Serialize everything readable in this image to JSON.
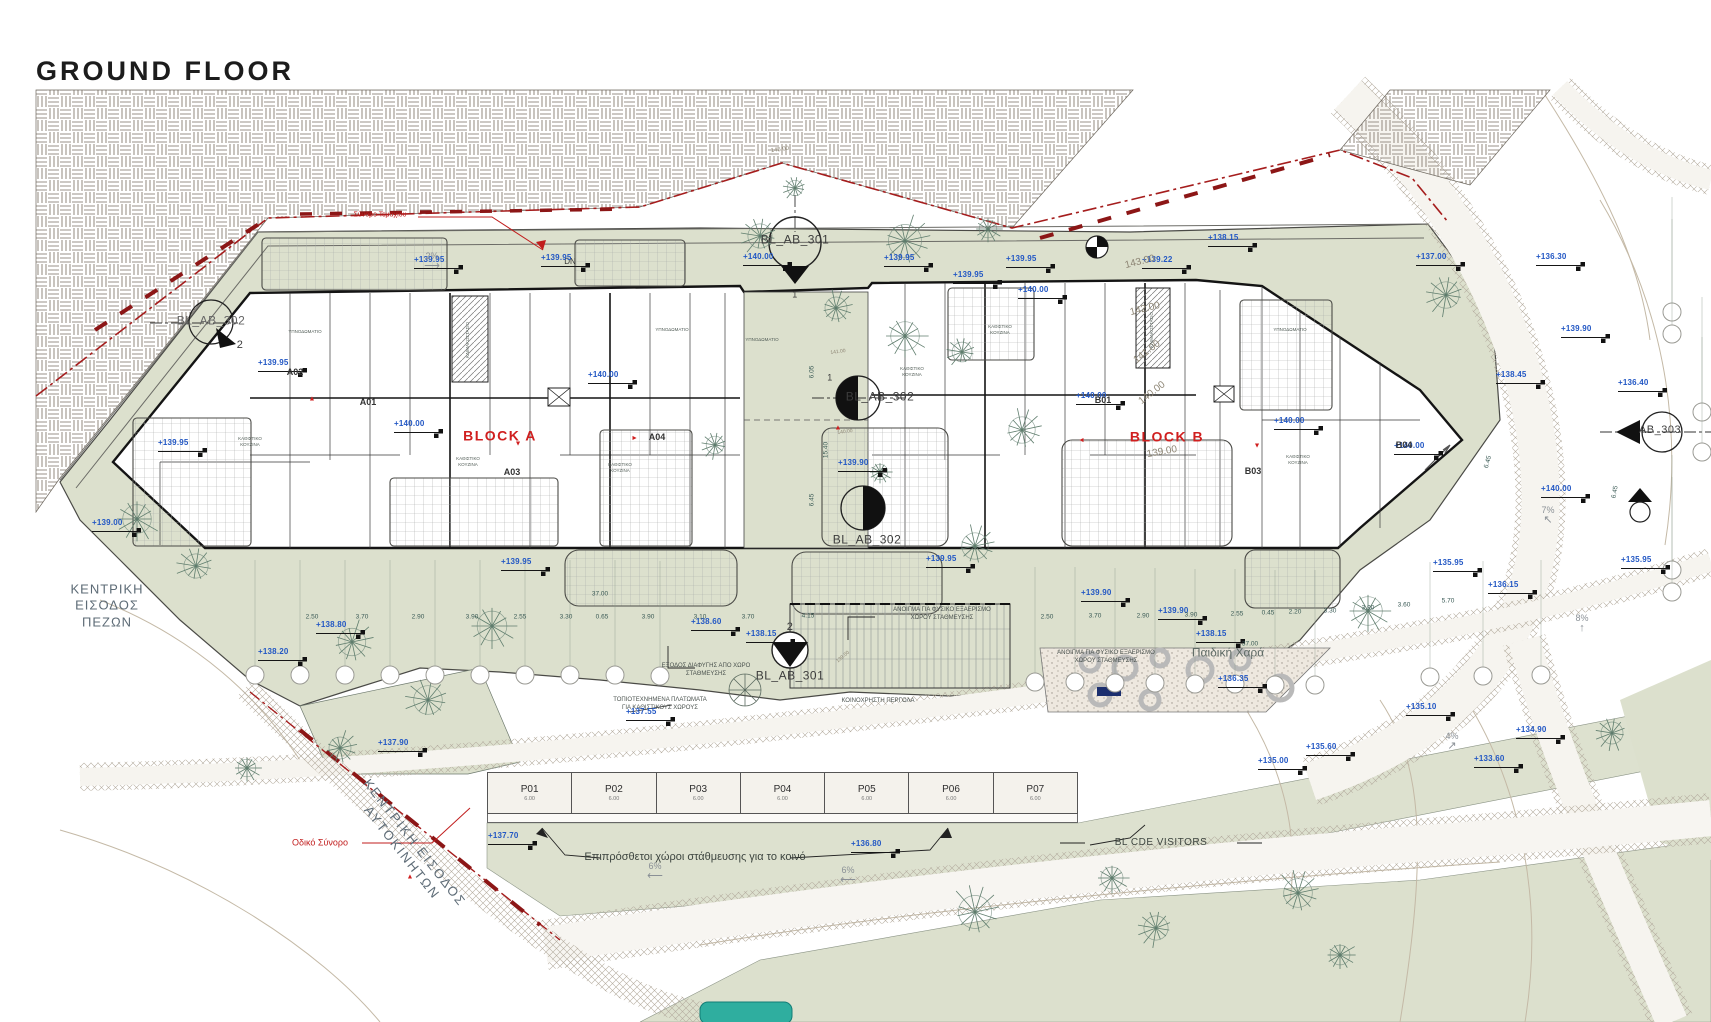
{
  "title": "GROUND FLOOR",
  "blocks": {
    "a": "BLOCK A",
    "b": "BLOCK B"
  },
  "sections": {
    "top": {
      "label": "BL_AB_301",
      "num": "1"
    },
    "bottom": {
      "label": "BL_AB_301",
      "num": "2"
    },
    "left": {
      "label": "BL_AB_302",
      "num": "2"
    },
    "mid_upper": {
      "label": "BL_AB_302",
      "num": "1"
    },
    "mid_lower": {
      "label": "BL_AB_302"
    },
    "right": {
      "label": "AB_303"
    }
  },
  "entrances": {
    "pedestrian": "ΚΕΝΤΡΙΚΗ\nΕΙΣΟΔΟΣ\nΠΕΖΩΝ",
    "vehicular": "ΚΕΝΤΡΙΚΗ ΕΙΣΟΔΟΣ\nΑΥΤΟΚΙΝΗΤΩΝ"
  },
  "boundaries": {
    "road": "Οδικό Σύνορο",
    "plot": "Σύνορο Τεμαχίου"
  },
  "misc": {
    "dn": "DN",
    "playground": "Παιδική Χαρά"
  },
  "parking": {
    "stalls": [
      {
        "id": "P01",
        "len": "6.00"
      },
      {
        "id": "P02",
        "len": "6.00"
      },
      {
        "id": "P03",
        "len": "6.00"
      },
      {
        "id": "P04",
        "len": "6.00"
      },
      {
        "id": "P05",
        "len": "6.00"
      },
      {
        "id": "P06",
        "len": "6.00"
      },
      {
        "id": "P07",
        "len": "6.00"
      }
    ],
    "public_note": "Επιπρόσθετοι χώροι στάθμευσης για το κοινό",
    "visitors_note": "BL CDE VISITORS"
  },
  "site_notes": [
    {
      "text": "ΚΟΙΝΟΧΡΗΣΤΗ ΠΕΡΓΟΛΑ",
      "x": 878,
      "y": 701,
      "size": 6
    },
    {
      "text": "ΤΟΠΙΟΤΕΧΝΗΜΕΝΑ ΠΛΑΤΩΜΑΤΑ\nΓΙΑ ΚΑΘΙΣΤΙΚΟΥΣ ΧΩΡΟΥΣ",
      "x": 660,
      "y": 704,
      "size": 6
    },
    {
      "text": "ΑΝΟΙΓΜΑ ΓΙΑ ΦΥΣΙΚΟ ΕΞΑΕΡΙΣΜΟ\nΧΩΡΟΥ ΣΤΑΘΜΕΥΣΗΣ",
      "x": 942,
      "y": 614,
      "size": 6
    },
    {
      "text": "ΑΝΟΙΓΜΑ ΓΙΑ ΦΥΣΙΚΟ ΕΞΑΕΡΙΣΜΟ\nΧΩΡΟΥ ΣΤΑΘΜΕΥΣΗΣ",
      "x": 1106,
      "y": 657,
      "size": 6
    },
    {
      "text": "ΕΞΟΔΟΣ ΔΙΑΦΥΓΗΣ ΑΠΟ ΧΩΡΟ\nΣΤΑΘΜΕΥΣΗΣ",
      "x": 706,
      "y": 670,
      "size": 6
    }
  ],
  "elevations": [
    {
      "v": "+139.95",
      "x": 418,
      "y": 269
    },
    {
      "v": "+139.95",
      "x": 545,
      "y": 267
    },
    {
      "v": "+140.00",
      "x": 747,
      "y": 266
    },
    {
      "v": "+139.95",
      "x": 888,
      "y": 267
    },
    {
      "v": "+139.95",
      "x": 1010,
      "y": 268
    },
    {
      "v": "+139.95",
      "x": 957,
      "y": 284
    },
    {
      "v": "+140.00",
      "x": 1022,
      "y": 299
    },
    {
      "v": "+139.22",
      "x": 1146,
      "y": 269
    },
    {
      "v": "+138.15",
      "x": 1212,
      "y": 247
    },
    {
      "v": "+137.00",
      "x": 1420,
      "y": 266
    },
    {
      "v": "+136.30",
      "x": 1540,
      "y": 266
    },
    {
      "v": "+139.90",
      "x": 1565,
      "y": 338
    },
    {
      "v": "+136.40",
      "x": 1622,
      "y": 392
    },
    {
      "v": "+138.45",
      "x": 1500,
      "y": 384
    },
    {
      "v": "+139.95",
      "x": 262,
      "y": 372
    },
    {
      "v": "+139.95",
      "x": 162,
      "y": 452
    },
    {
      "v": "+139.00",
      "x": 96,
      "y": 532
    },
    {
      "v": "+140.00",
      "x": 398,
      "y": 433
    },
    {
      "v": "+140.00",
      "x": 592,
      "y": 384
    },
    {
      "v": "+140.00",
      "x": 1080,
      "y": 405
    },
    {
      "v": "+140.00",
      "x": 1278,
      "y": 430
    },
    {
      "v": "+140.00",
      "x": 1398,
      "y": 455
    },
    {
      "v": "+139.90",
      "x": 842,
      "y": 472
    },
    {
      "v": "+139.95",
      "x": 505,
      "y": 571
    },
    {
      "v": "+139.95",
      "x": 930,
      "y": 568
    },
    {
      "v": "+139.90",
      "x": 1085,
      "y": 602
    },
    {
      "v": "+139.90",
      "x": 1162,
      "y": 620
    },
    {
      "v": "+138.60",
      "x": 695,
      "y": 631
    },
    {
      "v": "+138.15",
      "x": 750,
      "y": 643
    },
    {
      "v": "+138.15",
      "x": 1200,
      "y": 643
    },
    {
      "v": "+138.80",
      "x": 320,
      "y": 634
    },
    {
      "v": "+138.20",
      "x": 262,
      "y": 661
    },
    {
      "v": "+137.55",
      "x": 630,
      "y": 721
    },
    {
      "v": "+137.90",
      "x": 382,
      "y": 752
    },
    {
      "v": "+137.70",
      "x": 492,
      "y": 845
    },
    {
      "v": "+136.80",
      "x": 855,
      "y": 853
    },
    {
      "v": "+136.35",
      "x": 1222,
      "y": 688
    },
    {
      "v": "+135.10",
      "x": 1410,
      "y": 716
    },
    {
      "v": "+135.60",
      "x": 1310,
      "y": 756
    },
    {
      "v": "+134.90",
      "x": 1520,
      "y": 739
    },
    {
      "v": "+135.00",
      "x": 1262,
      "y": 770
    },
    {
      "v": "+133.60",
      "x": 1478,
      "y": 768
    },
    {
      "v": "+136.15",
      "x": 1492,
      "y": 594
    },
    {
      "v": "+135.95",
      "x": 1625,
      "y": 569
    },
    {
      "v": "+135.95",
      "x": 1437,
      "y": 572
    },
    {
      "v": "+140.00",
      "x": 1545,
      "y": 498
    }
  ],
  "contours": [
    {
      "v": "145.00",
      "x": 780,
      "y": 150,
      "r": -8,
      "size": 6
    },
    {
      "v": "143.00",
      "x": 1140,
      "y": 262,
      "r": -14,
      "size": 10
    },
    {
      "v": "142.00",
      "x": 1145,
      "y": 309,
      "r": -14,
      "size": 10
    },
    {
      "v": "141.00",
      "x": 1147,
      "y": 352,
      "r": -38,
      "size": 10
    },
    {
      "v": "140.00",
      "x": 1152,
      "y": 393,
      "r": -38,
      "size": 10
    },
    {
      "v": "139.00",
      "x": 1162,
      "y": 452,
      "r": -10,
      "size": 10
    },
    {
      "v": "141.00",
      "x": 838,
      "y": 352,
      "r": -8,
      "size": 5
    },
    {
      "v": "140.00",
      "x": 845,
      "y": 432,
      "r": -8,
      "size": 5
    },
    {
      "v": "139.00",
      "x": 843,
      "y": 657,
      "r": -40,
      "size": 5
    }
  ],
  "dims": [
    {
      "v": "2.50",
      "x": 312,
      "y": 617
    },
    {
      "v": "3.70",
      "x": 362,
      "y": 617
    },
    {
      "v": "2.90",
      "x": 418,
      "y": 617
    },
    {
      "v": "3.90",
      "x": 472,
      "y": 617
    },
    {
      "v": "2.55",
      "x": 520,
      "y": 617
    },
    {
      "v": "3.30",
      "x": 566,
      "y": 617
    },
    {
      "v": "0.65",
      "x": 602,
      "y": 617
    },
    {
      "v": "3.90",
      "x": 648,
      "y": 617
    },
    {
      "v": "3.10",
      "x": 700,
      "y": 617
    },
    {
      "v": "3.70",
      "x": 748,
      "y": 617
    },
    {
      "v": "4.15",
      "x": 808,
      "y": 616
    },
    {
      "v": "2.50",
      "x": 1047,
      "y": 617
    },
    {
      "v": "3.70",
      "x": 1095,
      "y": 616
    },
    {
      "v": "2.90",
      "x": 1143,
      "y": 616
    },
    {
      "v": "3.90",
      "x": 1191,
      "y": 615
    },
    {
      "v": "2.55",
      "x": 1237,
      "y": 614
    },
    {
      "v": "0.45",
      "x": 1268,
      "y": 613
    },
    {
      "v": "2.20",
      "x": 1295,
      "y": 612
    },
    {
      "v": "3.30",
      "x": 1330,
      "y": 611
    },
    {
      "v": "3.90",
      "x": 1368,
      "y": 608
    },
    {
      "v": "3.60",
      "x": 1404,
      "y": 605
    },
    {
      "v": "5.70",
      "x": 1448,
      "y": 601
    },
    {
      "v": "37.00",
      "x": 600,
      "y": 594
    },
    {
      "v": "37.00",
      "x": 1250,
      "y": 644
    },
    {
      "v": "6.05",
      "x": 812,
      "y": 372,
      "r": -90
    },
    {
      "v": "15.40",
      "x": 826,
      "y": 450,
      "r": -90
    },
    {
      "v": "6.45",
      "x": 812,
      "y": 500,
      "r": -90
    },
    {
      "v": "6.45",
      "x": 1488,
      "y": 462,
      "r": -75
    },
    {
      "v": "6.45",
      "x": 1615,
      "y": 492,
      "r": -80
    }
  ],
  "slopes": [
    {
      "v": "2%",
      "x": 432,
      "y": 262,
      "a": "⟶"
    },
    {
      "v": "6%",
      "x": 655,
      "y": 872,
      "a": "⟵"
    },
    {
      "v": "6%",
      "x": 848,
      "y": 876,
      "a": "⟵"
    },
    {
      "v": "4%",
      "x": 1452,
      "y": 742,
      "a": "↗"
    },
    {
      "v": "7%",
      "x": 1548,
      "y": 516,
      "a": "↖"
    },
    {
      "v": "8%",
      "x": 1582,
      "y": 624,
      "a": "↑"
    }
  ],
  "units": [
    {
      "id": "A01",
      "x": 368,
      "y": 402
    },
    {
      "id": "A02",
      "x": 295,
      "y": 372
    },
    {
      "id": "A03",
      "x": 512,
      "y": 472
    },
    {
      "id": "A04",
      "x": 657,
      "y": 437
    },
    {
      "id": "B01",
      "x": 1103,
      "y": 400
    },
    {
      "id": "B03",
      "x": 1253,
      "y": 471
    },
    {
      "id": "B04",
      "x": 1404,
      "y": 445
    }
  ],
  "rooms": [
    {
      "t": "ΚΑΘΙΣΤΙΚΟ\nΚΟΥΖΙΝΑ",
      "x": 250,
      "y": 442
    },
    {
      "t": "ΥΠΝΟΔΩΜΑΤΙΟ",
      "x": 305,
      "y": 332
    },
    {
      "t": "ΚΑΘΙΣΤΙΚΟ\nΚΟΥΖΙΝΑ",
      "x": 468,
      "y": 462
    },
    {
      "t": "ΥΠΝΟΔΩΜΑΤΙΟ",
      "x": 672,
      "y": 330
    },
    {
      "t": "ΚΑΘΙΣΤΙΚΟ\nΚΟΥΖΙΝΑ",
      "x": 620,
      "y": 468
    },
    {
      "t": "ΥΠΝΟΔΩΜΑΤΙΟ",
      "x": 762,
      "y": 340
    },
    {
      "t": "ΚΑΘΙΣΤΙΚΟ\nΚΟΥΖΙΝΑ",
      "x": 912,
      "y": 372
    },
    {
      "t": "ΚΑΘΙΣΤΙΚΟ\nΚΟΥΖΙΝΑ",
      "x": 1000,
      "y": 330
    },
    {
      "t": "ΥΠΝΟΔΩΜΑΤΙΟ",
      "x": 1290,
      "y": 330
    },
    {
      "t": "ΚΑΘΙΣΤΙΚΟ\nΚΟΥΖΙΝΑ",
      "x": 1298,
      "y": 460
    },
    {
      "t": "ΚΛΙΜΑΚΟΣΤΑΣΙΟ",
      "x": 468,
      "y": 340,
      "r": -90
    },
    {
      "t": "ΚΛΙΜΑΚΟΣΤΑΣΙΟ",
      "x": 1152,
      "y": 330,
      "r": -90
    }
  ],
  "red_marks": [
    {
      "x": 312,
      "y": 399,
      "r": 0
    },
    {
      "x": 518,
      "y": 443,
      "r": 180
    },
    {
      "x": 634,
      "y": 438,
      "r": 90
    },
    {
      "x": 838,
      "y": 428,
      "r": 0
    },
    {
      "x": 1082,
      "y": 440,
      "r": -90
    },
    {
      "x": 1257,
      "y": 445,
      "r": 180
    },
    {
      "x": 410,
      "y": 877,
      "r": 0
    }
  ],
  "trees": [
    {
      "x": 137,
      "y": 519,
      "s": 26
    },
    {
      "x": 196,
      "y": 566,
      "s": 22
    },
    {
      "x": 352,
      "y": 642,
      "s": 25
    },
    {
      "x": 492,
      "y": 626,
      "s": 27
    },
    {
      "x": 428,
      "y": 700,
      "s": 26
    },
    {
      "x": 340,
      "y": 748,
      "s": 20
    },
    {
      "x": 247,
      "y": 768,
      "s": 16
    },
    {
      "x": 760,
      "y": 236,
      "s": 22
    },
    {
      "x": 905,
      "y": 241,
      "s": 30
    },
    {
      "x": 988,
      "y": 229,
      "s": 16
    },
    {
      "x": 795,
      "y": 188,
      "s": 14
    },
    {
      "x": 836,
      "y": 308,
      "s": 20
    },
    {
      "x": 905,
      "y": 336,
      "s": 26
    },
    {
      "x": 962,
      "y": 352,
      "s": 18
    },
    {
      "x": 1022,
      "y": 430,
      "s": 24
    },
    {
      "x": 880,
      "y": 472,
      "s": 14
    },
    {
      "x": 715,
      "y": 445,
      "s": 16
    },
    {
      "x": 975,
      "y": 546,
      "s": 24
    },
    {
      "x": 1368,
      "y": 611,
      "s": 26
    },
    {
      "x": 1446,
      "y": 295,
      "s": 24
    },
    {
      "x": 975,
      "y": 912,
      "s": 30
    },
    {
      "x": 1112,
      "y": 878,
      "s": 20
    },
    {
      "x": 1156,
      "y": 928,
      "s": 22
    },
    {
      "x": 1298,
      "y": 893,
      "s": 26
    },
    {
      "x": 1340,
      "y": 955,
      "s": 18
    },
    {
      "x": 1612,
      "y": 733,
      "s": 20
    }
  ],
  "bubbles": [
    {
      "x": 255,
      "y": 675
    },
    {
      "x": 300,
      "y": 675
    },
    {
      "x": 345,
      "y": 675
    },
    {
      "x": 390,
      "y": 675
    },
    {
      "x": 435,
      "y": 675
    },
    {
      "x": 480,
      "y": 675
    },
    {
      "x": 525,
      "y": 675
    },
    {
      "x": 570,
      "y": 675
    },
    {
      "x": 615,
      "y": 675
    },
    {
      "x": 660,
      "y": 676
    },
    {
      "x": 1035,
      "y": 682
    },
    {
      "x": 1075,
      "y": 682
    },
    {
      "x": 1115,
      "y": 683
    },
    {
      "x": 1155,
      "y": 683
    },
    {
      "x": 1195,
      "y": 684
    },
    {
      "x": 1235,
      "y": 684
    },
    {
      "x": 1275,
      "y": 685
    },
    {
      "x": 1315,
      "y": 685
    },
    {
      "x": 1430,
      "y": 677
    },
    {
      "x": 1483,
      "y": 676
    },
    {
      "x": 1541,
      "y": 675
    },
    {
      "x": 1672,
      "y": 312
    },
    {
      "x": 1672,
      "y": 334
    },
    {
      "x": 1672,
      "y": 570
    },
    {
      "x": 1672,
      "y": 592
    },
    {
      "x": 1702,
      "y": 412
    },
    {
      "x": 1702,
      "y": 452
    }
  ],
  "colors": {
    "green": "#dce0cd",
    "hatch_line": "#9a9288",
    "red_boundary": "#a51d1d",
    "elev_blue": "#2257c4",
    "block_red": "#d01f1f",
    "teal_object": "#2fae9f",
    "navy_object": "#1b2e6e"
  }
}
